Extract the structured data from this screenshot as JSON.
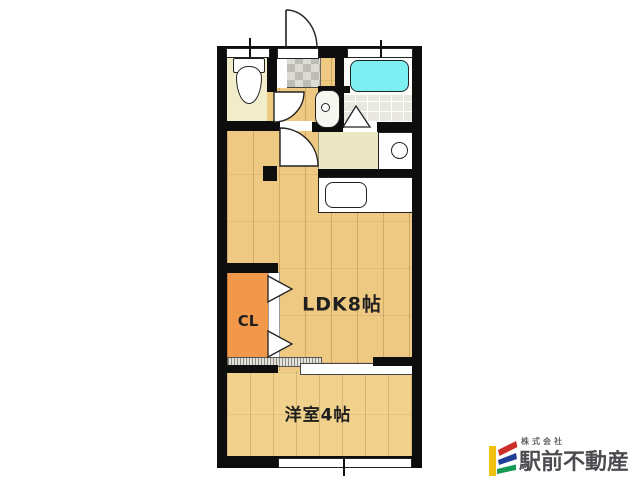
{
  "plan": {
    "rooms": {
      "ldk": {
        "label": "LDK8帖"
      },
      "western": {
        "label": "洋室4帖"
      },
      "closet": {
        "label": "CL"
      }
    },
    "fixtures": [
      "toilet",
      "washbasin",
      "bathtub",
      "bathroom-folding-door",
      "kitchen-sink",
      "stove-burner",
      "entrance-swing-door",
      "toilet-swing-door",
      "hall-swing-door",
      "closet-bifold-door",
      "sliding-door",
      "window"
    ],
    "colors": {
      "wall": "#0d0d0d",
      "wood_floor": "#edc981",
      "western_floor": "#f1d28d",
      "closet": "#f2984a",
      "toilet_floor": "#f1ecca",
      "bathtub": "#7deef1",
      "entry_tiles": "#bdbdb5",
      "counter": "#ebe6c4"
    }
  },
  "branding": {
    "company_prefix": "株式会社",
    "company_name": "駅前不動産",
    "logo_colors": {
      "yellow": "#f0c010",
      "red": "#cc2f2a",
      "blue": "#1f3f99",
      "green": "#169a53"
    }
  }
}
